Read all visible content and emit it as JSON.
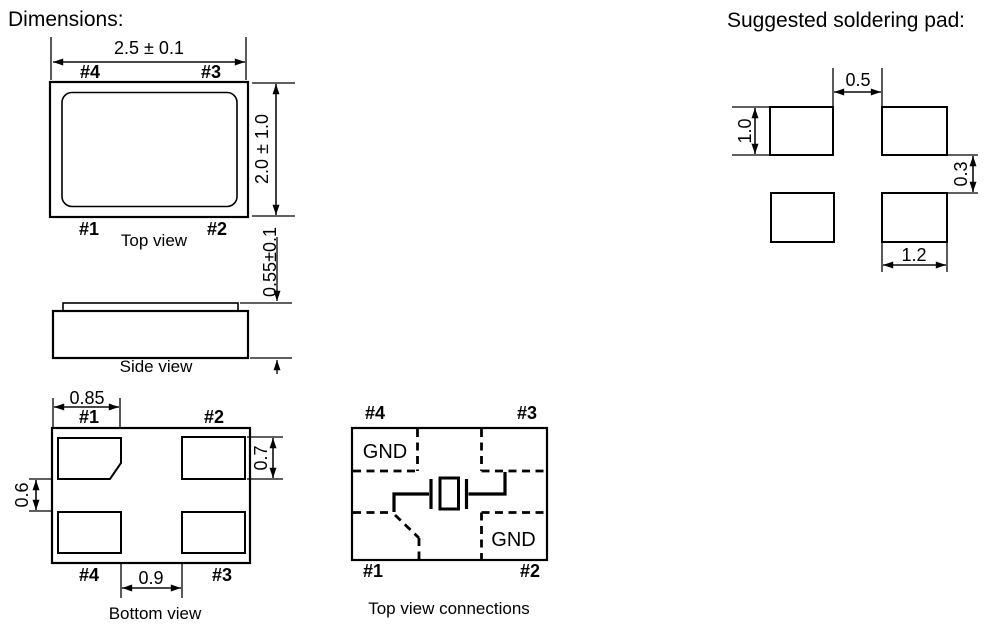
{
  "colors": {
    "accent_red": "#ec1c23",
    "line_black": "#000000",
    "background": "#ffffff"
  },
  "headings": {
    "dimensions": "Dimensions:",
    "soldering_pad": "Suggested soldering pad",
    "soldering_pad_colon": ":"
  },
  "top_view": {
    "caption": "Top view",
    "dim_width": "2.5 ± 0.1",
    "dim_height": "2.0 ± 1.0",
    "pin_top_left": "#4",
    "pin_top_right": "#3",
    "pin_bottom_left": "#1",
    "pin_bottom_right": "#2"
  },
  "side_view": {
    "caption": "Side view",
    "dim_height": "0.55±0.1"
  },
  "bottom_view": {
    "caption": "Bottom view",
    "pin_top_left": "#1",
    "pin_top_right": "#2",
    "pin_bottom_left": "#4",
    "pin_bottom_right": "#3",
    "dim_pad_width": "0.85",
    "dim_pad_height": "0.7",
    "dim_pad_gap_vertical": "0.6",
    "dim_pad_gap_horizontal": "0.9"
  },
  "connections_view": {
    "caption": "Top view connections",
    "pin_top_left": "#4",
    "pin_top_right": "#3",
    "pin_bottom_left": "#1",
    "pin_bottom_right": "#2",
    "gnd_top_left": "GND",
    "gnd_bottom_right": "GND"
  },
  "soldering_pad_view": {
    "dim_gap_horizontal": "0.5",
    "dim_pad_height": "1.0",
    "dim_gap_vertical": "0.3",
    "dim_pad_width": "1.2"
  }
}
